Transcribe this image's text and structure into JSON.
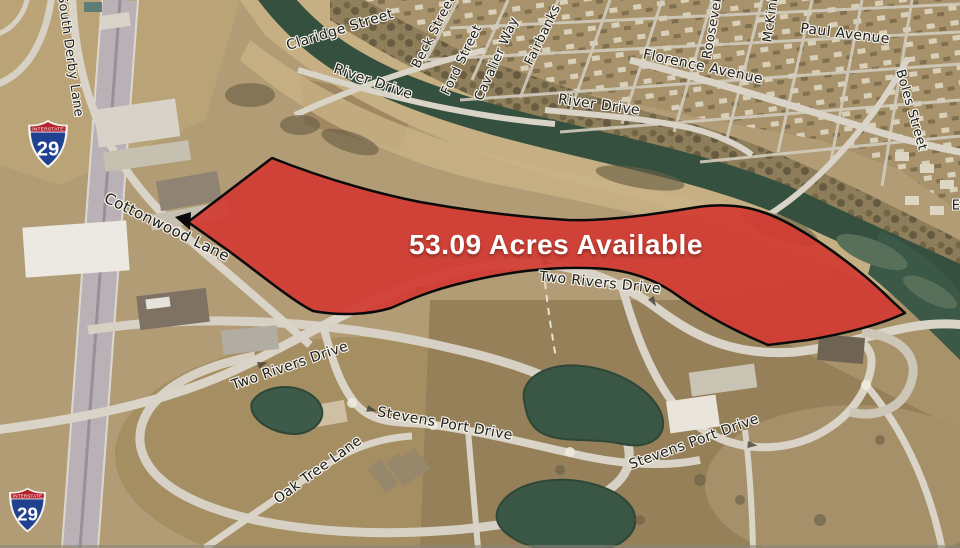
{
  "map": {
    "acreage_label": "53.09 Acres Available",
    "parcel": {
      "fill": "#d23b33",
      "outline": "#0a0a0a"
    },
    "shields": [
      {
        "id": "interstate-29-north",
        "top_label": "INTERSTATE",
        "number": "29"
      },
      {
        "id": "interstate-29-south",
        "top_label": "INTERSTATE",
        "number": "29"
      }
    ],
    "street_labels": [
      {
        "id": "south-derby-lane",
        "text": "South Derby Lane"
      },
      {
        "id": "claridge-street",
        "text": "Claridge Street"
      },
      {
        "id": "beck-street",
        "text": "Beck Street"
      },
      {
        "id": "ford-street",
        "text": "Ford Street"
      },
      {
        "id": "cavalier-way",
        "text": "Cavalier Way"
      },
      {
        "id": "fairbanks",
        "text": "Fairbanks"
      },
      {
        "id": "river-drive-west",
        "text": "River Drive"
      },
      {
        "id": "florence-avenue",
        "text": "Florence Avenue"
      },
      {
        "id": "roosevelt",
        "text": "Roosevelt"
      },
      {
        "id": "mckinley",
        "text": "McKinley"
      },
      {
        "id": "paul-avenue",
        "text": "Paul Avenue"
      },
      {
        "id": "river-drive-east",
        "text": "River Drive"
      },
      {
        "id": "boles-street",
        "text": "Boles Street"
      },
      {
        "id": "cottonwood-lane",
        "text": "Cottonwood Lane"
      },
      {
        "id": "two-rivers-drive-east",
        "text": "Two Rivers Drive"
      },
      {
        "id": "two-rivers-drive-west",
        "text": "Two Rivers Drive"
      },
      {
        "id": "stevens-port-drive-west",
        "text": "Stevens Port Drive"
      },
      {
        "id": "stevens-port-drive-south",
        "text": "Stevens Port Drive"
      },
      {
        "id": "oak-tree-lane",
        "text": "Oak Tree Lane"
      },
      {
        "id": "edge-partial-east",
        "text": "E"
      }
    ],
    "colors": {
      "water": "#35503f",
      "sand": "#c6b083",
      "land": "#b29c75",
      "road": "#d9d4c7",
      "highway": "#b9b1b5",
      "residential": "#a8926b",
      "interstate_red": "#b6212e",
      "interstate_blue": "#204190"
    }
  }
}
